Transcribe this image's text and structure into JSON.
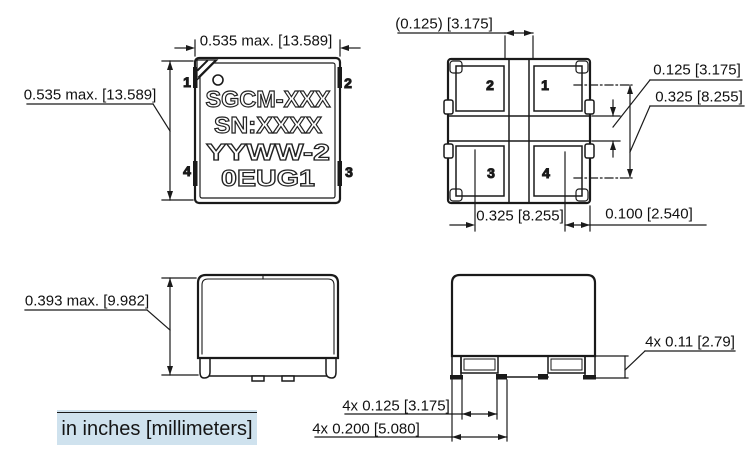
{
  "top_view": {
    "marking_lines": [
      "SGCM-XXX",
      "SN:XXXX",
      "YYWW-2",
      "0EUG1"
    ],
    "pins": {
      "p1": "1",
      "p2": "2",
      "p3": "3",
      "p4": "4"
    },
    "dim_width": "0.535 max. [13.589]",
    "dim_height": "0.535 max. [13.589]"
  },
  "bottom_view": {
    "pads": {
      "p1": "1",
      "p2": "2",
      "p3": "3",
      "p4": "4"
    },
    "dim_center_gap": "(0.125) [3.175]",
    "dim_pad_gap": "0.125 [3.175]",
    "dim_pad_pitch_vertical": "0.325 [8.255]",
    "dim_pad_pitch_horizontal": "0.325 [8.255]",
    "dim_pad_to_edge": "0.100 [2.540]"
  },
  "side_view_a": {
    "dim_height": "0.393 max. [9.982]"
  },
  "side_view_b": {
    "dim_terminal_height": "4x 0.11 [2.79]",
    "dim_terminal_width": "4x 0.125 [3.175]",
    "dim_terminal_span": "4x 0.200 [5.080]"
  },
  "footer": {
    "units_note": "in inches [millimeters]"
  },
  "colors": {
    "line": "#1a1a1a",
    "text": "#111111",
    "highlight": "#cfe2ee"
  }
}
